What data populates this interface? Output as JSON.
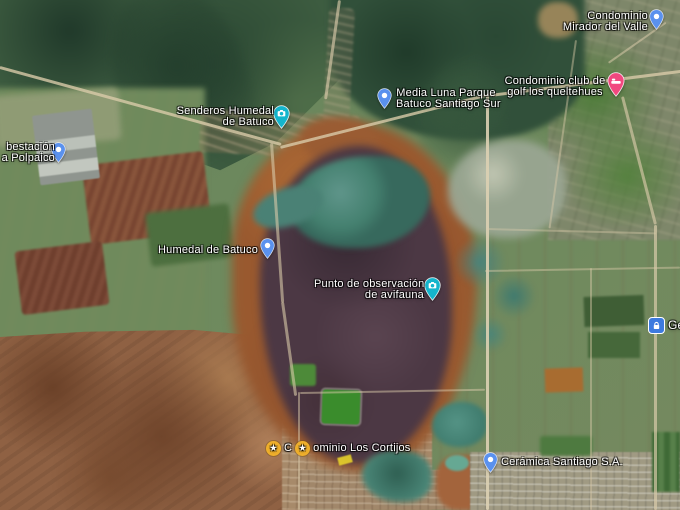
{
  "map": {
    "view": "satellite",
    "place_labels": [
      {
        "name": "condominio-mirador-del-valle",
        "lines": [
          "Condominio",
          "Mirador del Valle"
        ],
        "marker": "blue-pin"
      },
      {
        "name": "condominio-club-de-golf-los-queltehues",
        "lines": [
          "Condominio club de",
          "golf los queltehues"
        ],
        "marker": "pink-lodging-pin"
      },
      {
        "name": "media-luna-parque-batuco-santiago-sur",
        "lines": [
          "Media Luna Parque",
          "Batuco Santiago Sur"
        ],
        "marker": "blue-pin"
      },
      {
        "name": "senderos-humedal-de-batuco",
        "lines": [
          "Senderos Humedal",
          "de Batuco"
        ],
        "marker": "teal-attraction-pin"
      },
      {
        "name": "subestacion-polpaico",
        "lines": [
          "bestación",
          "a Polpaico"
        ],
        "marker": "blue-pin"
      },
      {
        "name": "humedal-de-batuco",
        "lines": [
          "Humedal de Batuco"
        ],
        "marker": "blue-pin"
      },
      {
        "name": "punto-de-observacion-de-avifauna",
        "lines": [
          "Punto de observación",
          "de avifauna"
        ],
        "marker": "teal-attraction-pin"
      },
      {
        "name": "condominio-los-cortijos",
        "fragments": [
          "C",
          "ominio Los Cortijos"
        ],
        "stars": 2,
        "marker": "yellow-star-saved"
      },
      {
        "name": "ceramica-santiago",
        "lines": [
          "Cerámica Santiago S.A."
        ],
        "marker": "blue-pin"
      },
      {
        "name": "poi-ge",
        "lines": [
          "Ge"
        ],
        "marker": "blue-square-poi"
      }
    ],
    "marker_colors": {
      "blue_pin": "#5A91EE",
      "teal_attraction_pin": "#14B5CC",
      "pink_lodging_pin": "#F1487F",
      "saved_star": "#F0B02C",
      "blue_square_poi": "#3D7ADF"
    }
  }
}
